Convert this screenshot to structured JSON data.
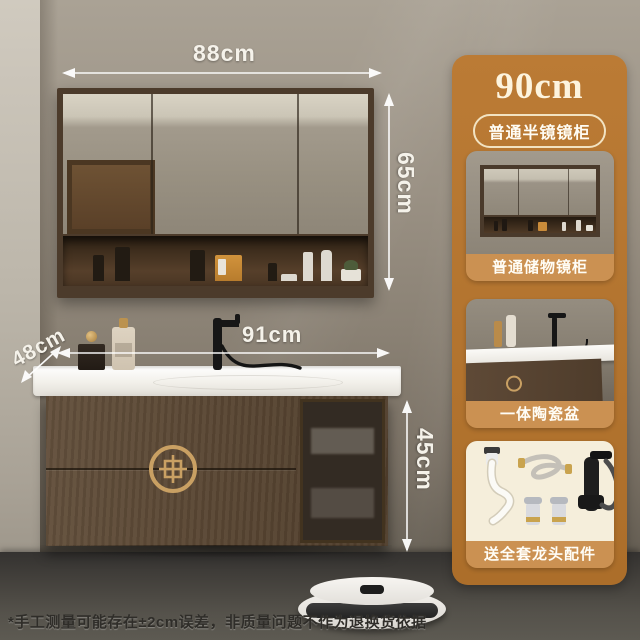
{
  "annotations": {
    "mirror_width": "88cm",
    "mirror_height": "65cm",
    "counter_width": "91cm",
    "counter_depth": "48cm",
    "cabinet_height": "45cm"
  },
  "disclaimer": "*手工测量可能存在±2cm误差，非质量问题不作为退换货依据",
  "sidebar": {
    "title": "90cm",
    "badge": "普通半镜镜柜",
    "items": [
      {
        "label": "普通储物镜柜"
      },
      {
        "label": "一体陶瓷盆"
      },
      {
        "label": "送全套龙头配件"
      }
    ]
  },
  "colors": {
    "panel_orange": "#b3742f",
    "caption_band": "#cb9152",
    "card_cream": "#f6efdd",
    "badge_border": "#f2e3c2",
    "dimension_text": "#f5f2ea"
  }
}
